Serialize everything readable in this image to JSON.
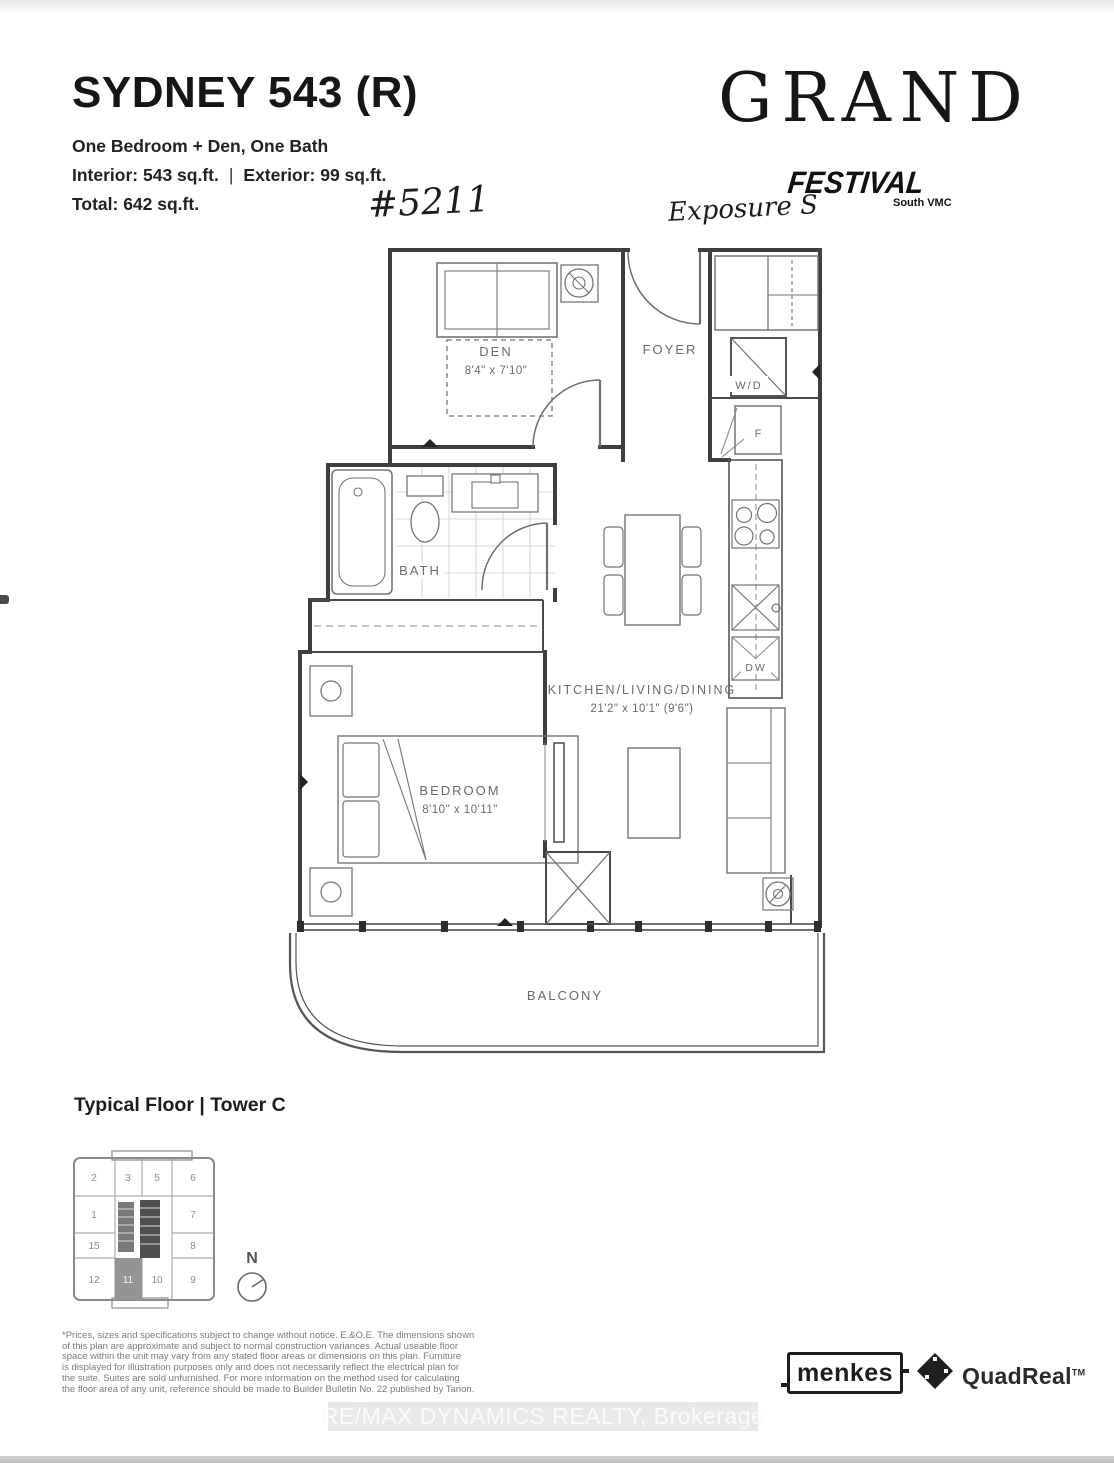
{
  "header": {
    "plan_name": "SYDNEY 543 (R)",
    "subtitle": "One Bedroom + Den, One Bath",
    "interior": "Interior: 543 sq.ft.",
    "separator": "|",
    "exterior": "Exterior: 99 sq.ft.",
    "total": "Total: 642 sq.ft.",
    "unit_handwritten": "#5211"
  },
  "brand": {
    "name": "GRAND",
    "festival": "FESTIVAL",
    "tagline": "South VMC",
    "exposure": "Exposure S"
  },
  "floorplan": {
    "den": {
      "label": "DEN",
      "dims": "8'4\" x 7'10\""
    },
    "foyer": {
      "label": "FOYER"
    },
    "bath": {
      "label": "BATH"
    },
    "kld": {
      "label": "KITCHEN/LIVING/DINING",
      "dims": "21'2\" x 10'1\" (9'6\")"
    },
    "bedroom": {
      "label": "BEDROOM",
      "dims": "8'10\" x 10'11\""
    },
    "balcony": {
      "label": "BALCONY"
    },
    "wd": "W/D",
    "fridge": "F",
    "dw": "DW"
  },
  "keyplan": {
    "title": "Typical Floor | Tower C",
    "units": [
      "2",
      "3",
      "5",
      "6",
      "1",
      "7",
      "15",
      "8",
      "12",
      "11",
      "10",
      "9"
    ],
    "highlighted_unit": "11",
    "compass": "N"
  },
  "footer": {
    "disclaimer_lines": [
      "*Prices, sizes and specifications subject to change without notice. E.&O.E. The dimensions shown",
      "of this plan are approximate and subject to normal construction variances. Actual useable floor",
      "space within the unit may vary from any stated floor areas or dimensions on this plan. Furniture",
      "is displayed for illustration purposes only and does not necessarily reflect the electrical plan for",
      "the suite. Suites are sold unfurnished. For more information on the method used for calculating",
      "the floor area of any unit, reference should be made to Builder Bulletin No. 22 published by Tarion."
    ],
    "menkes": "menkes",
    "quadreal": "QuadReal",
    "quadreal_tm": "TM",
    "watermark": "RE/MAX DYNAMICS REALTY, Brokerage"
  },
  "colors": {
    "wall": "#3e3e3e",
    "fixture": "#757575",
    "label": "#6b6b6b",
    "highlight_cell": "#949494"
  }
}
